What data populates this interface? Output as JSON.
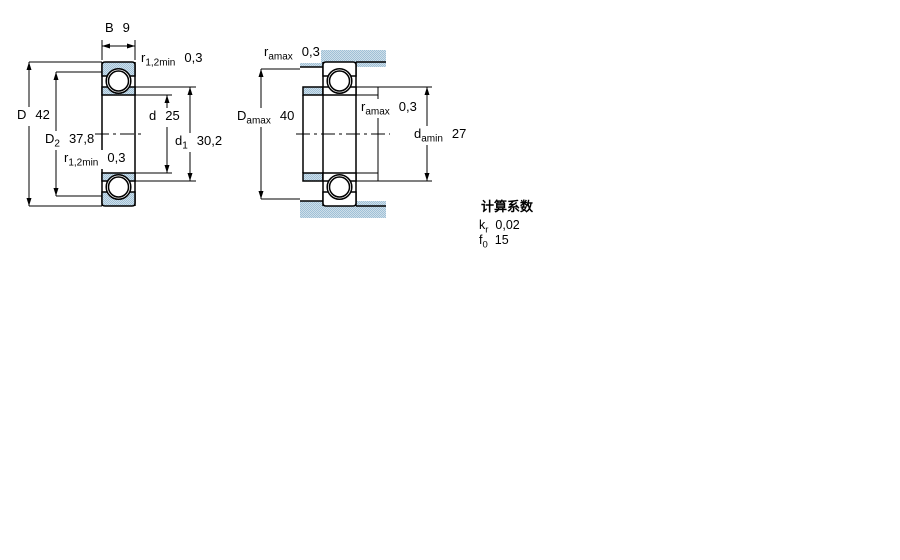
{
  "figure": {
    "title_hint": "deep-groove-ball-bearing-dimension-drawing",
    "left_view": {
      "b": {
        "sym": "B",
        "val": "9"
      },
      "r12_top": {
        "sym": "r",
        "sub": "1,2min",
        "val": "0,3"
      },
      "D": {
        "sym": "D",
        "val": "42"
      },
      "D2": {
        "sym": "D",
        "sub": "2",
        "val": "37,8"
      },
      "r12_bottom": {
        "sym": "r",
        "sub": "1,2min",
        "val": "0,3"
      },
      "d": {
        "sym": "d",
        "val": "25"
      },
      "d1": {
        "sym": "d",
        "sub": "1",
        "val": "30,2"
      }
    },
    "right_view": {
      "ramax_top": {
        "sym": "r",
        "sub": "amax",
        "val": "0,3"
      },
      "Damax": {
        "sym": "D",
        "sub": "amax",
        "val": "40"
      },
      "ramax_mid": {
        "sym": "r",
        "sub": "amax",
        "val": "0,3"
      },
      "damin": {
        "sym": "d",
        "sub": "amin",
        "val": "27"
      }
    },
    "calculation_factors": {
      "title": "计算系数",
      "kr": {
        "sym": "k",
        "sub": "r",
        "val": "0,02"
      },
      "f0": {
        "sym": "f",
        "sub": "0",
        "val": "15"
      }
    },
    "colors": {
      "section_fill": "#9fc0d7",
      "section_fill_light": "#cfdfe9",
      "line": "#000000"
    }
  }
}
